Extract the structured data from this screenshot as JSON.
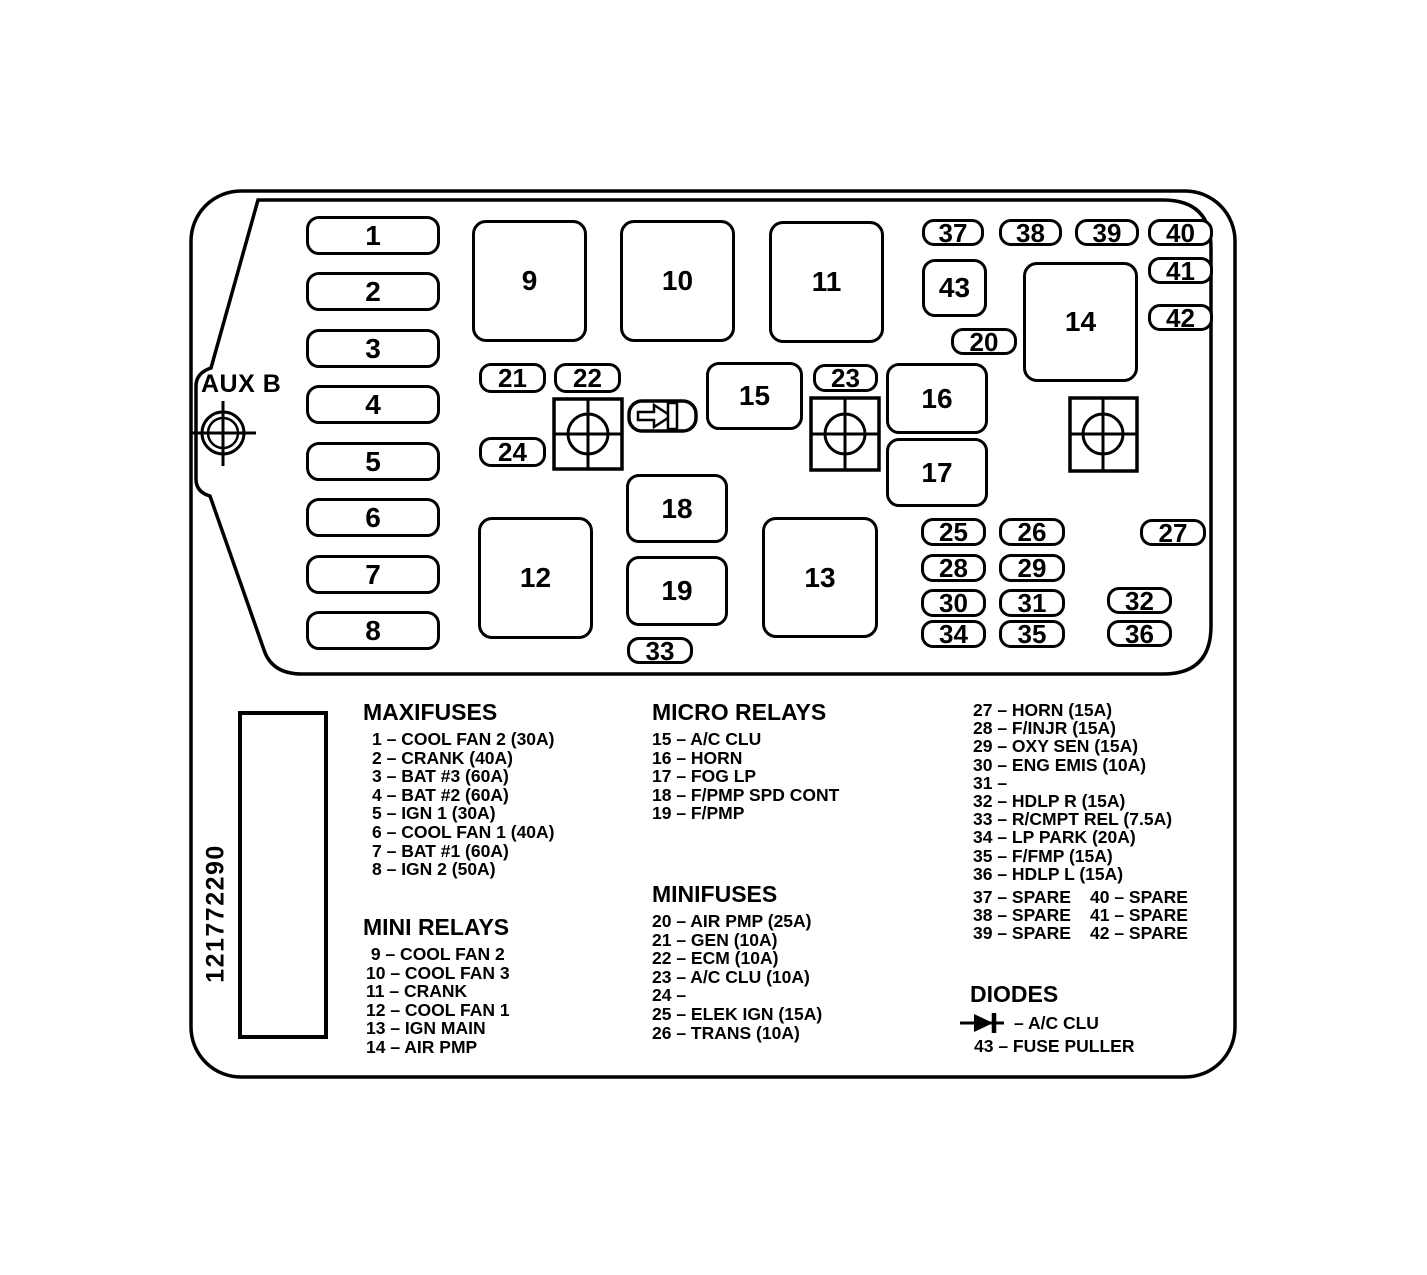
{
  "part_number": "121772290",
  "aux_label": "AUX B",
  "colors": {
    "line": "#000000",
    "background": "#ffffff"
  },
  "diagram": {
    "box_labels": [
      "1",
      "2",
      "3",
      "4",
      "5",
      "6",
      "7",
      "8",
      "9",
      "10",
      "11",
      "12",
      "13",
      "14",
      "15",
      "16",
      "17",
      "18",
      "19",
      "20",
      "21",
      "22",
      "23",
      "24",
      "25",
      "26",
      "27",
      "28",
      "29",
      "30",
      "31",
      "32",
      "33",
      "34",
      "35",
      "36",
      "37",
      "38",
      "39",
      "40",
      "41",
      "42",
      "43"
    ]
  },
  "legend": {
    "maxifuses": {
      "title": "MAXIFUSES",
      "items": [
        "1 – COOL FAN 2 (30A)",
        "2 – CRANK (40A)",
        "3 – BAT #3 (60A)",
        "4 – BAT #2 (60A)",
        "5 – IGN 1 (30A)",
        "6 – COOL FAN 1 (40A)",
        "7 – BAT #1 (60A)",
        "8 – IGN 2 (50A)"
      ]
    },
    "mini_relays": {
      "title": "MINI RELAYS",
      "items": [
        " 9 – COOL FAN 2",
        "10 – COOL FAN 3",
        "11 – CRANK",
        "12 – COOL FAN 1",
        "13 – IGN MAIN",
        "14 – AIR PMP"
      ]
    },
    "micro_relays": {
      "title": "MICRO RELAYS",
      "items": [
        "15 – A/C CLU",
        "16 – HORN",
        "17 – FOG LP",
        "18 – F/PMP SPD CONT",
        "19 – F/PMP"
      ]
    },
    "minifuses": {
      "title": "MINIFUSES",
      "items": [
        "20 – AIR PMP (25A)",
        "21 – GEN (10A)",
        "22 – ECM (10A)",
        "23 – A/C CLU (10A)",
        "24 –",
        "25 – ELEK IGN (15A)",
        "26 – TRANS (10A)"
      ]
    },
    "minifuses_cont": {
      "items": [
        "27 – HORN (15A)",
        "28 – F/INJR (15A)",
        "29 – OXY SEN (15A)",
        "30 – ENG EMIS (10A)",
        "31 –",
        "32 – HDLP R (15A)",
        "33 – R/CMPT REL (7.5A)",
        "34 – LP PARK (20A)",
        "35 – F/FMP (15A)",
        "36 – HDLP L (15A)"
      ],
      "spares": [
        {
          "left": "37 – SPARE",
          "right": "40 – SPARE"
        },
        {
          "left": "38 – SPARE",
          "right": "41 – SPARE"
        },
        {
          "left": "39 – SPARE",
          "right": "42 – SPARE"
        }
      ]
    },
    "diodes": {
      "title": "DIODES",
      "diode_item": "– A/C CLU",
      "fuse_puller": "43 – FUSE PULLER"
    }
  }
}
